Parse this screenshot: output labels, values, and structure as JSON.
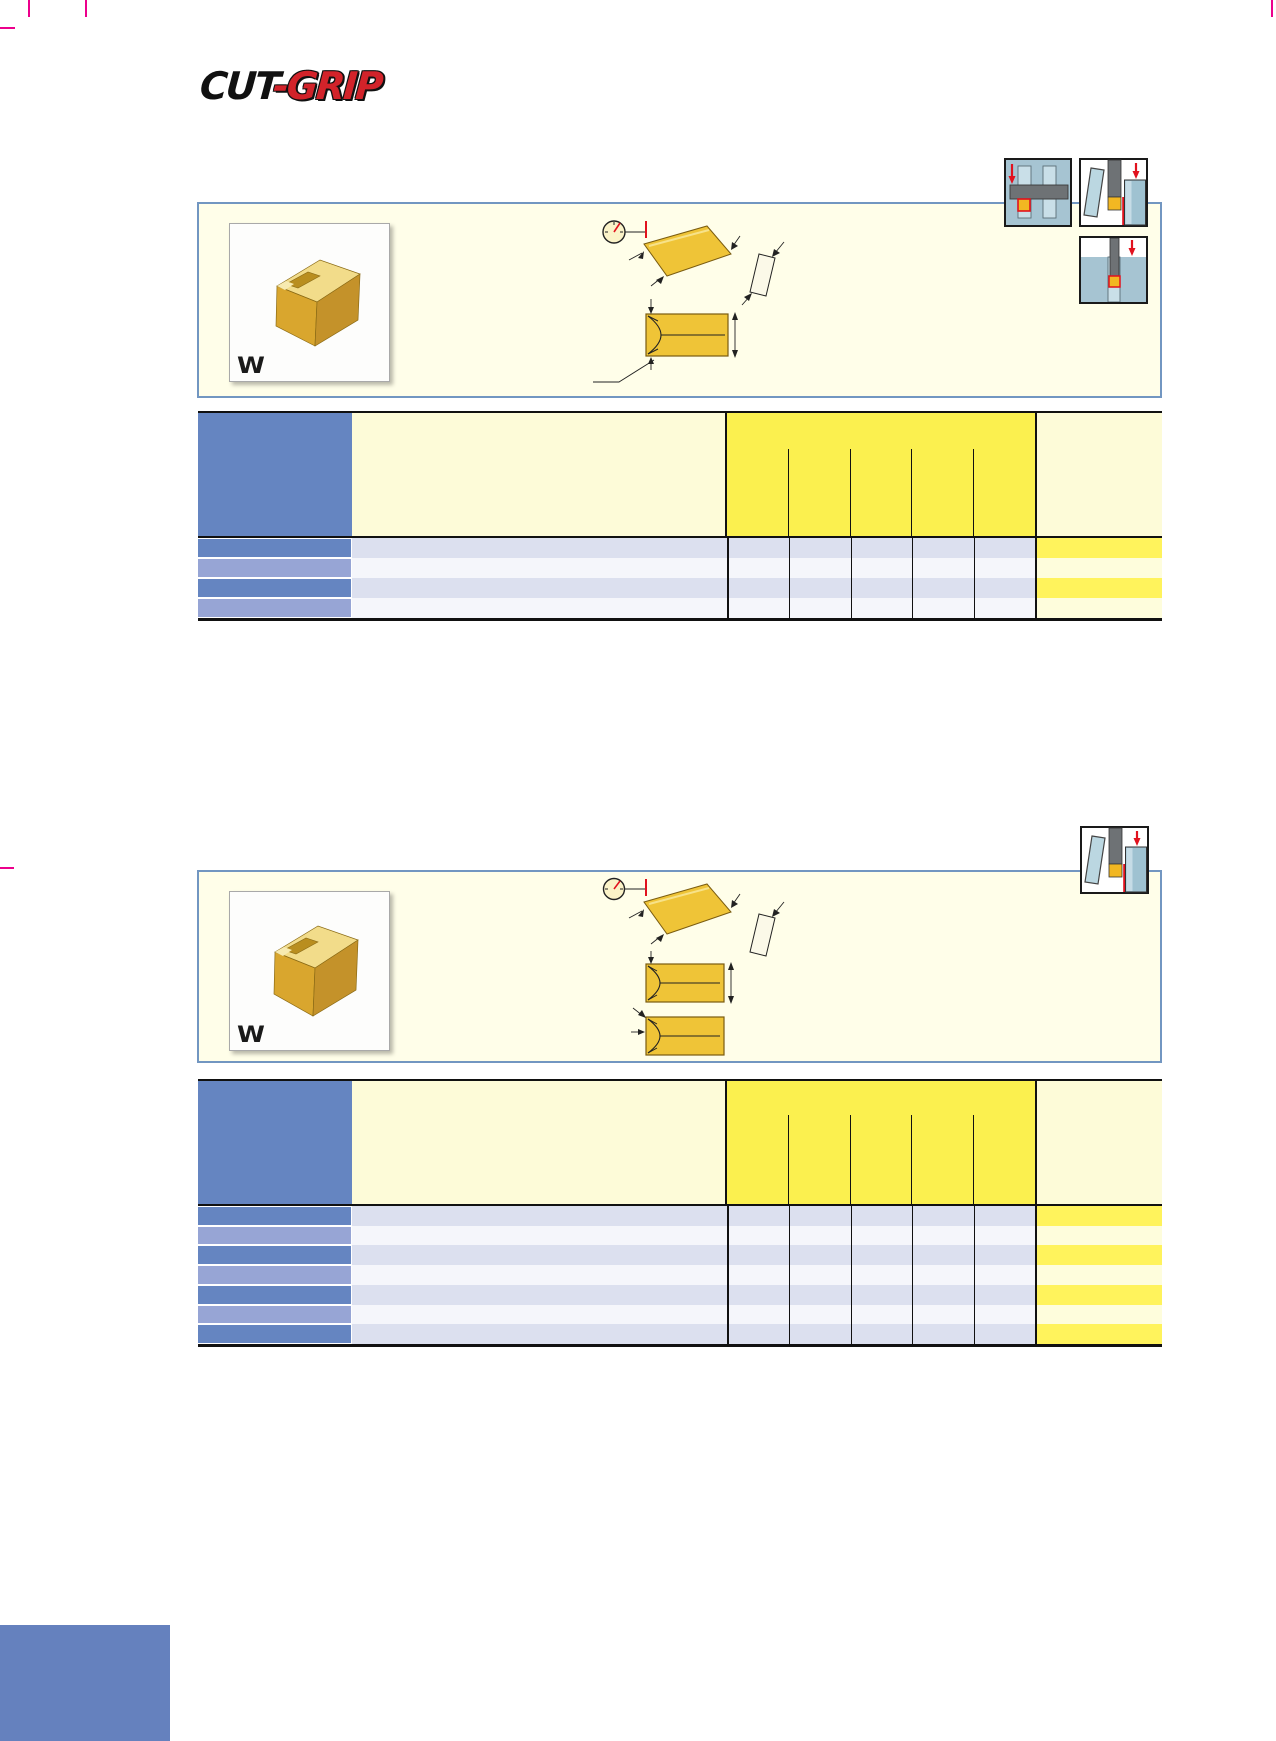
{
  "logo": {
    "part1": "CUT",
    "part2": "-GRIP"
  },
  "sections": [
    {
      "insert_label": "W",
      "insert_image": "gold-grooving-insert-3d",
      "drawing": "insert-profile-and-front-view-with-dimension-arrows-and-dial-indicator",
      "icons": [
        "face-groove-pulley-icon",
        "parting-off-icon",
        "deep-grooving-icon"
      ],
      "table": {
        "rows": 4,
        "dimension_subcolumns": 5,
        "cell_text": ""
      }
    },
    {
      "insert_label": "W",
      "insert_image": "gold-grooving-insert-3d",
      "drawing": "insert-profile-and-two-front-views-with-dimension-arrows-and-dial-indicator",
      "icons": [
        "parting-off-icon"
      ],
      "table": {
        "rows": 7,
        "dimension_subcolumns": 5,
        "cell_text": ""
      }
    }
  ],
  "colors": {
    "header_blue": "#6585C1",
    "row_blue_light": "#97A5D5",
    "row_lavender": "#DCE0EF",
    "row_pale": "#F5F6FB",
    "cream": "#FDFBD8",
    "panel_cream": "#FFFEE9",
    "bright_yellow": "#FBF04F",
    "row_yellow": "#FFF35C",
    "row_pale_yellow": "#FEFDDC",
    "panel_border": "#7296C1",
    "crop_mark_magenta": "#EC008C",
    "corner_block_blue": "#6581BE",
    "logo_red": "#D2232A",
    "insert_gold": "#EFC437",
    "icon_blue": "#A6C4D2",
    "icon_gray": "#6E7275",
    "icon_red": "#E1121E"
  }
}
